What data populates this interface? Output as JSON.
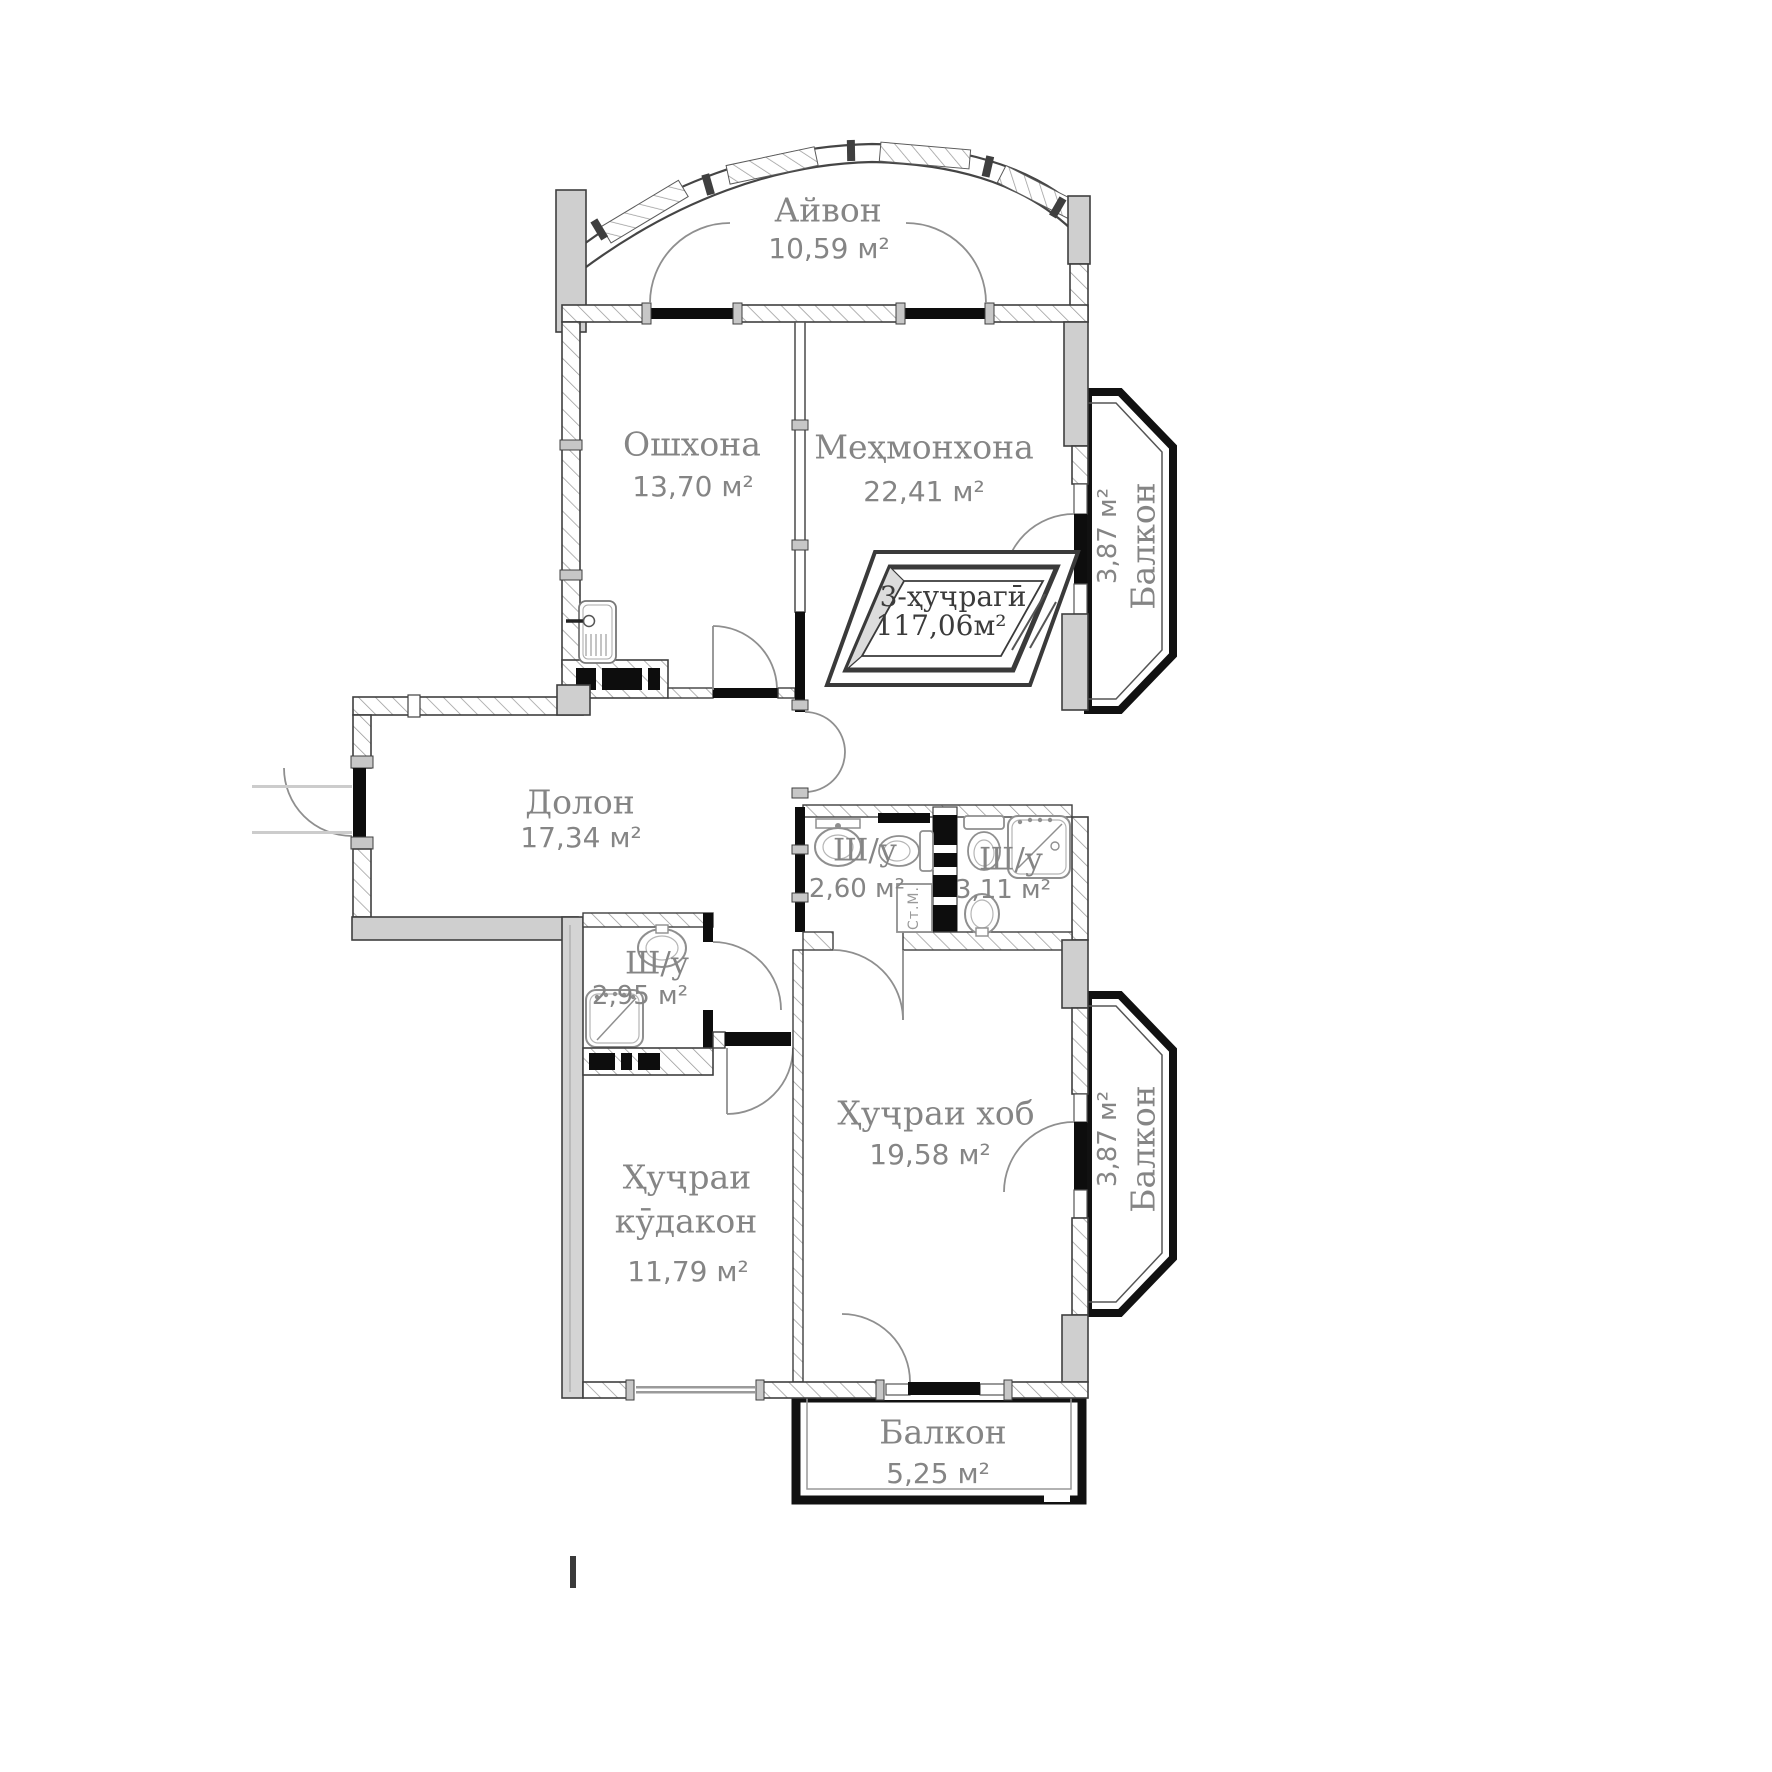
{
  "rooms": {
    "ayvon": {
      "name": "Айвон",
      "area": "10,59 м²"
    },
    "oshxona": {
      "name": "Ошхона",
      "area": "13,70 м²"
    },
    "mehmonxona": {
      "name": "Меҳмонхона",
      "area": "22,41 м²"
    },
    "dolon": {
      "name": "Долон",
      "area": "17,34 м²"
    },
    "shu_260": {
      "name": "Ш/у",
      "area": "2,60 м²"
    },
    "shu_311": {
      "name": "Ш/у",
      "area": "3,11 м²"
    },
    "shu_295": {
      "name": "Ш/у",
      "area": "2,95 м²"
    },
    "khujrai_khob": {
      "name": "Ҳуҷраи хоб",
      "area": "19,58 м²"
    },
    "khujrai_kudakon": {
      "name_line1": "Ҳуҷраи",
      "name_line2": "кӯдакон",
      "area": "11,79 м²"
    },
    "balkon_right_top": {
      "name": "Балкон",
      "area": "3,87 м²"
    },
    "balkon_right_bottom": {
      "name": "Балкон",
      "area": "3,87 м²"
    },
    "balkon_bottom": {
      "name": "Балкон",
      "area": "5,25 м²"
    }
  },
  "stamp": {
    "type_label": "3-ҳуҷрагӣ",
    "total_area": "117,06м²"
  },
  "appliances": {
    "washing_machine_label": "Ст.М."
  },
  "colors": {
    "label_text": "#858585",
    "stamp_text": "#3b3b3b",
    "wall_outline": "#3f3f3f",
    "window_sill": "#0d0d0d",
    "pillar_fill": "#cfcfcf",
    "balcony_outline": "#111111",
    "hatch_line": "#9a9a9a"
  }
}
